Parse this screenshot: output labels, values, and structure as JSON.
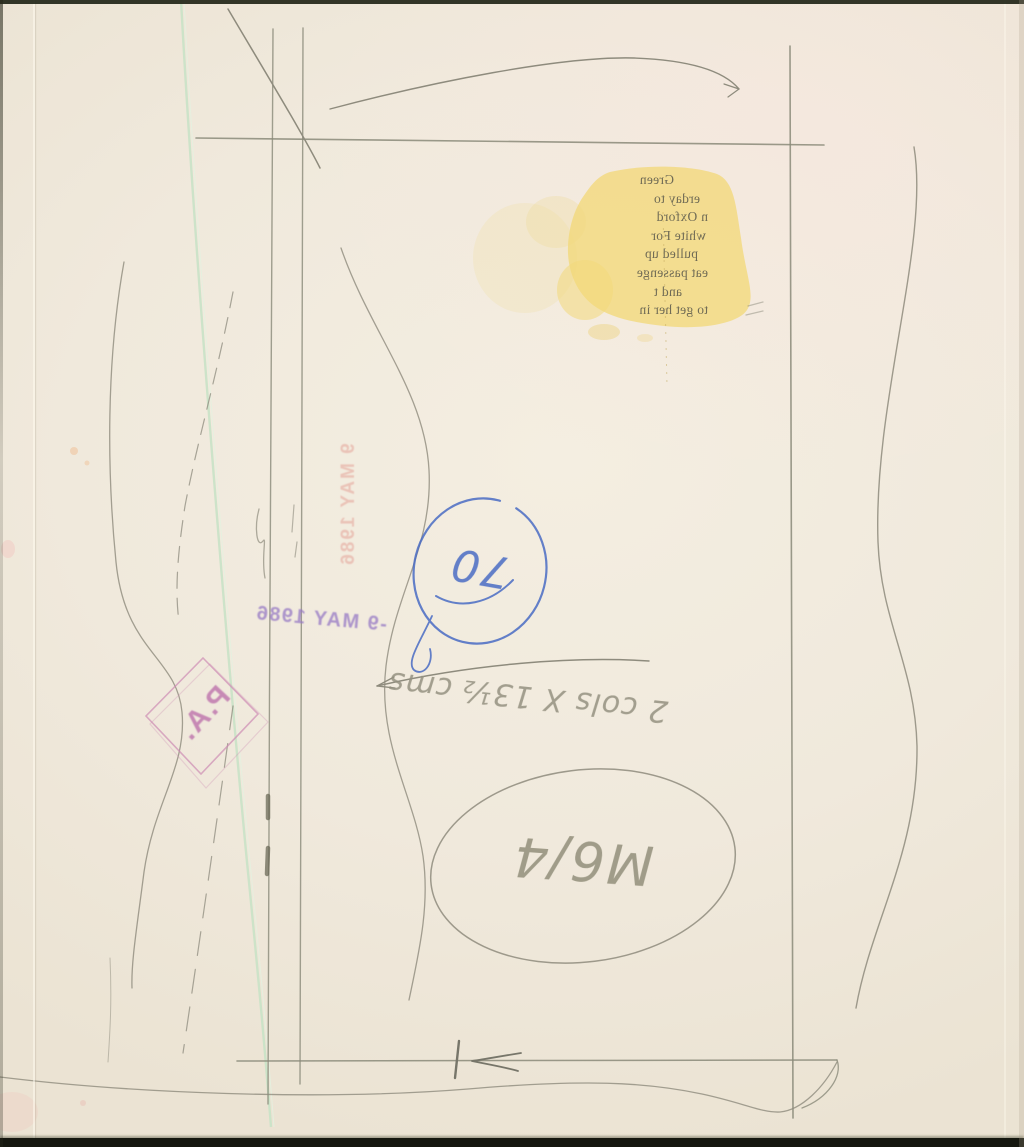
{
  "newsprint": {
    "lines": [
      "Green",
      "erday to",
      "n Oxford",
      "white For",
      "pulled up",
      "eat passenge",
      "and t",
      "to get her in"
    ]
  },
  "stamps": {
    "press_association": "P.A.",
    "date_purple": "-9 MAY 1986",
    "date_red": "9 MAY 1986"
  },
  "annotations": {
    "circled_number": "70",
    "size_note": "2 cols X 13½ cms",
    "reference_code": "M6/4"
  },
  "colors": {
    "paper": "#f0e9dc",
    "pencil": "#8e8b7d",
    "blue_ink": "#4a6cc4",
    "purple_stamp": "#9678c4",
    "red_stamp": "#e4a298",
    "pa_stamp": "#b056a0",
    "stain_yellow": "#f2d87a",
    "grease_green": "#c9e2c7"
  }
}
